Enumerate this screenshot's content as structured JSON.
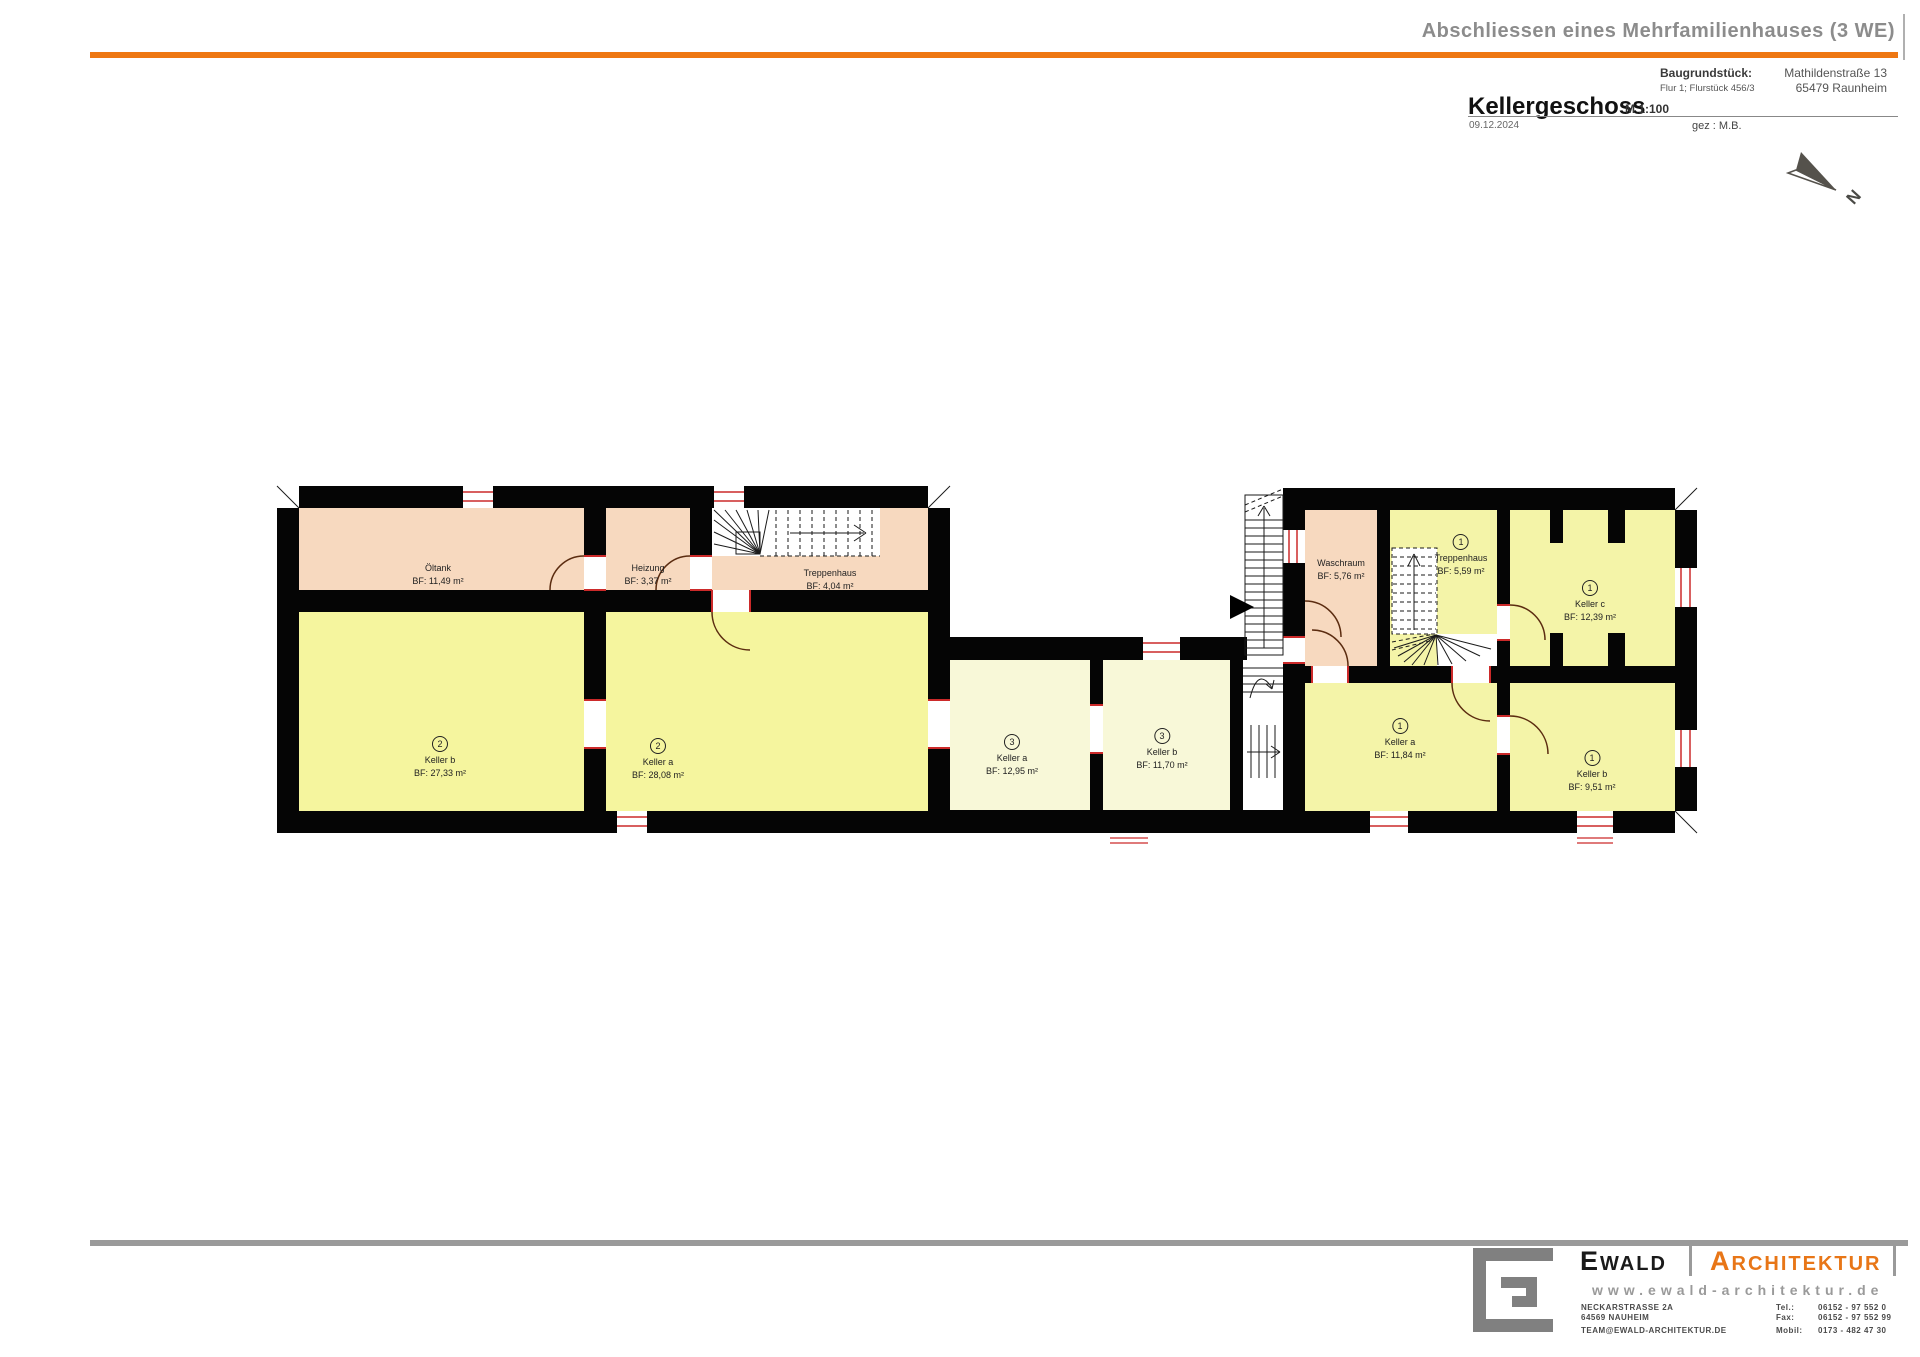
{
  "header": {
    "project_title": "Abschliessen eines Mehrfamilienhauses (3 WE)",
    "plot_label": "Baugrundstück:",
    "plot_value": "Flur 1; Flurstück 456/3",
    "address_line1": "Mathildenstraße 13",
    "address_line2": "65479 Raunheim",
    "drawing_title": "Kellergeschoss",
    "scale": "M 1:100",
    "date": "09.12.2024",
    "drawn_by": "gez : M.B.",
    "accent_color": "#ee7712"
  },
  "north": {
    "label": "N"
  },
  "plan": {
    "colors": {
      "wall": "#050505",
      "peach_room": "#f7d9bf",
      "yellow_left": "#f5f59e",
      "pale_middle": "#f8f8d8",
      "yellow_right": "#f4f4a8",
      "door_arc": "#5b2c10",
      "window_red": "#cc2a2a"
    },
    "rooms": [
      {
        "name": "Öltank",
        "area": "BF: 11,49 m²"
      },
      {
        "name": "Heizung",
        "area": "BF: 3,37 m²"
      },
      {
        "name": "Treppenhaus",
        "area": "BF: 4,04 m²"
      },
      {
        "unit": "2",
        "name": "Keller b",
        "area": "BF: 27,33 m²"
      },
      {
        "unit": "2",
        "name": "Keller a",
        "area": "BF: 28,08 m²"
      },
      {
        "unit": "3",
        "name": "Keller a",
        "area": "BF: 12,95 m²"
      },
      {
        "unit": "3",
        "name": "Keller b",
        "area": "BF: 11,70 m²"
      },
      {
        "name": "Waschraum",
        "area": "BF: 5,76 m²"
      },
      {
        "unit": "1",
        "name": "Treppenhaus",
        "area": "BF: 5,59 m²"
      },
      {
        "unit": "1",
        "name": "Keller c",
        "area": "BF: 12,39 m²"
      },
      {
        "unit": "1",
        "name": "Keller a",
        "area": "BF: 11,84 m²"
      },
      {
        "unit": "1",
        "name": "Keller b",
        "area": "BF: 9,51 m²"
      }
    ]
  },
  "footer": {
    "brand_first": "EWALD",
    "brand_second": "ARCHITEKTUR",
    "website": "www.ewald-architektur.de",
    "address_line1": "NECKARSTRASSE 2A",
    "address_line2": "64569 NAUHEIM",
    "email": "TEAM@EWALD-ARCHITEKTUR.DE",
    "tel_label": "Tel.:",
    "tel": "06152 - 97 552 0",
    "fax_label": "Fax:",
    "fax": "06152 - 97 552 99",
    "mobil_label": "Mobil:",
    "mobil": "0173 - 482 47 30"
  }
}
